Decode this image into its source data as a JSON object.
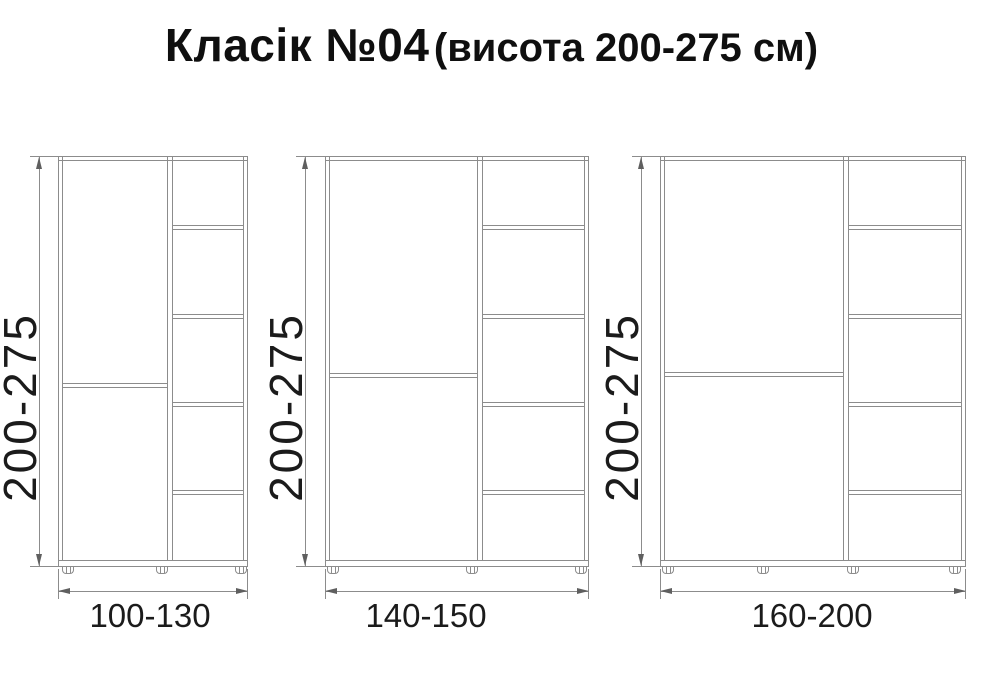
{
  "title": {
    "name_part": "Класік №04",
    "size_part": "(висота 200-275 см)"
  },
  "cabinets": [
    {
      "height_range": "200-275",
      "width_range": "100-130",
      "shelf_compartments": 5,
      "door_sections": 2,
      "feet_count": 3
    },
    {
      "height_range": "200-275",
      "width_range": "140-150",
      "shelf_compartments": 5,
      "door_sections": 2,
      "feet_count": 3
    },
    {
      "height_range": "200-275",
      "width_range": "160-200",
      "shelf_compartments": 5,
      "door_sections": 2,
      "feet_count": 4
    }
  ],
  "icons": {
    "dimension_arrows": [
      "arrow-up-icon",
      "arrow-down-icon",
      "arrow-left-icon",
      "arrow-right-icon"
    ]
  },
  "colors": {
    "line": "#8c8c8c",
    "arrow": "#5f5f5f",
    "text": "#1b1b1b",
    "background": "#ffffff"
  }
}
